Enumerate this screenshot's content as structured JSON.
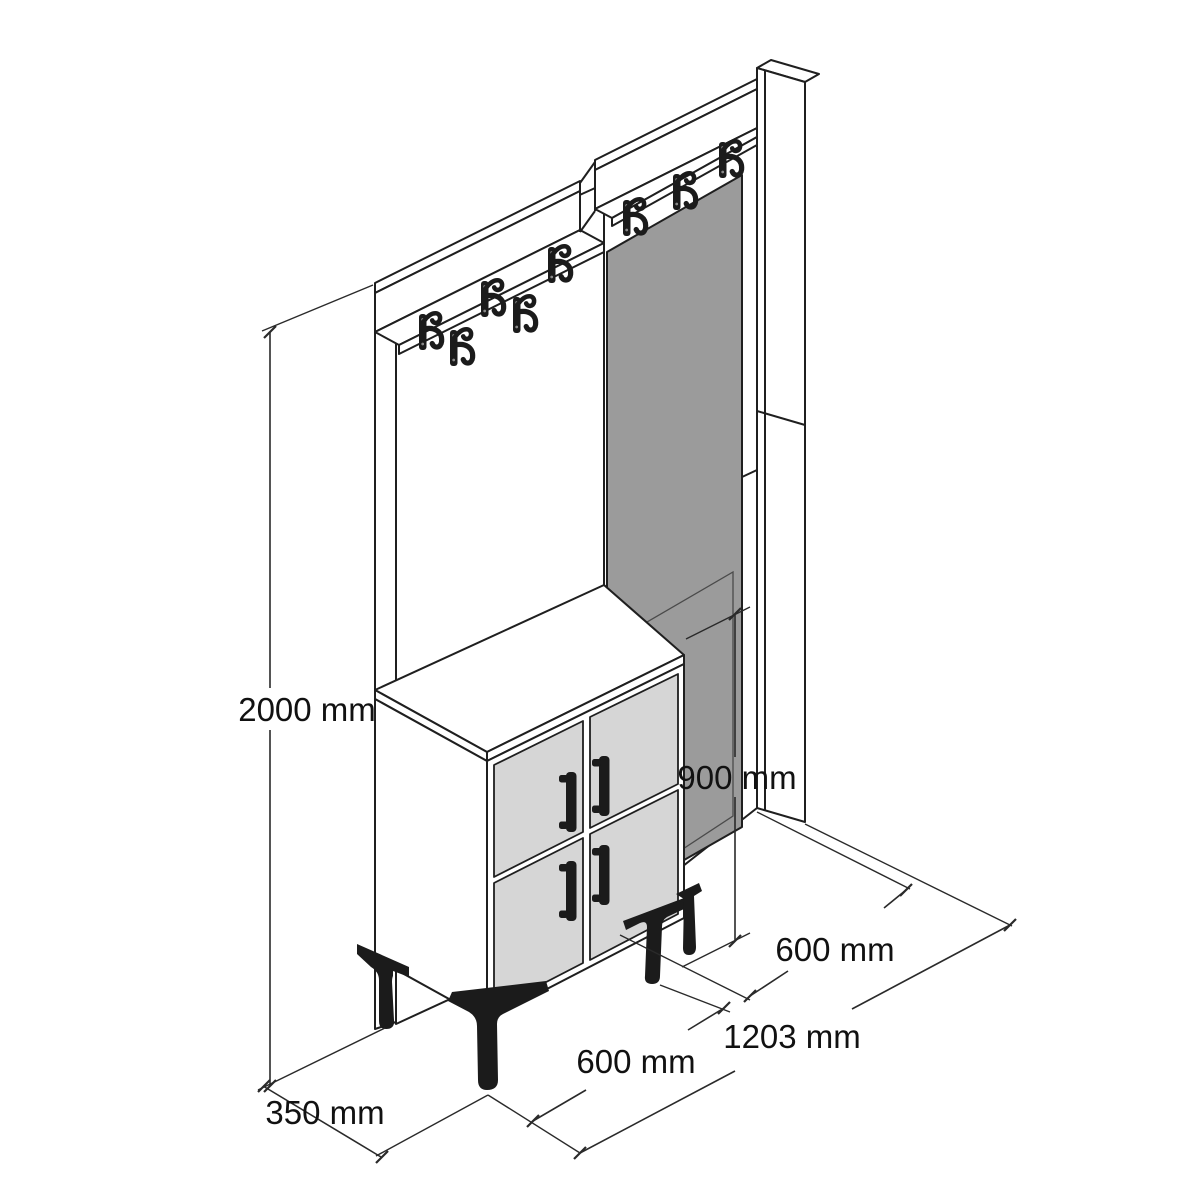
{
  "drawing": {
    "title": "Hallway unit with coat hooks, mirror and shoe cabinet — dimensioned technical drawing",
    "view": "isometric line drawing",
    "background": "#ffffff"
  },
  "dimensions": {
    "overall_height": "2000 mm",
    "cabinet_height": "900 mm",
    "right_panel_width": "600 mm",
    "overall_width": "1203 mm",
    "cabinet_width": "600 mm",
    "depth": "350 mm"
  },
  "components": {
    "left_panel": "coat hook panel with top shelf",
    "right_panel": "mirror panel with top shelf and side board",
    "cabinet": "four-door shoe cabinet on angled legs",
    "mirror": "rectangular mirror",
    "hooks": "double coat hooks",
    "handles": "vertical door handles",
    "legs": "angled metal legs"
  },
  "counts": {
    "coat_hooks_left_panel": 5,
    "coat_hooks_right_panel": 3,
    "cabinet_doors": 4,
    "door_handles": 4,
    "legs": 4
  },
  "colors": {
    "line": "#1f1f1f",
    "mirror_gray": "#9b9b9b",
    "door_gray": "#d6d6d6",
    "hardware_black": "#1b1b1b",
    "background": "#ffffff"
  }
}
